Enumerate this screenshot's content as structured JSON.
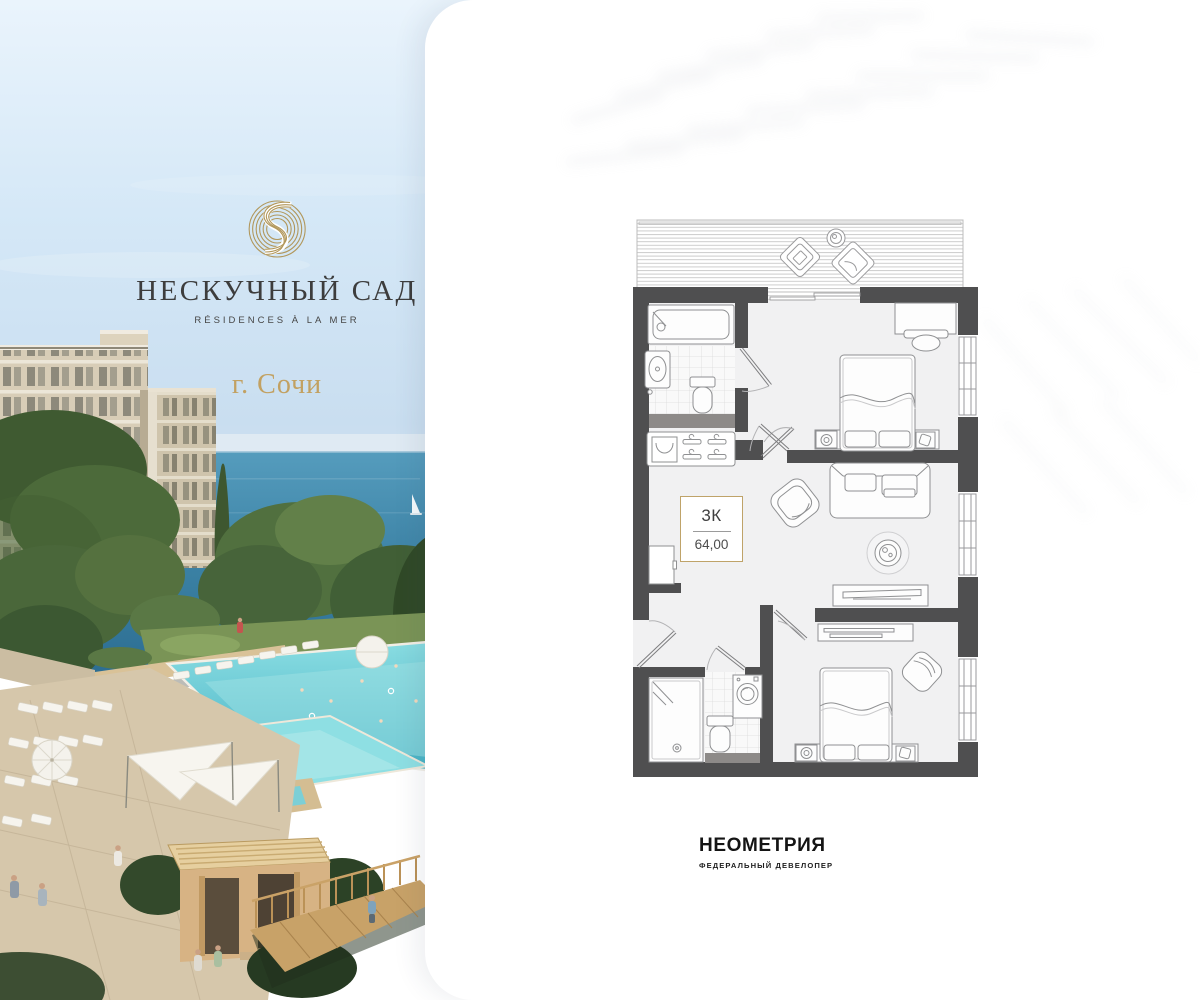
{
  "brand": {
    "name": "НЕСКУЧНЫЙ САД",
    "tagline": "RÉSIDENCES À LA MER",
    "city": "г. Сочи",
    "monogram_icon": "spiral-s-monogram-icon",
    "gold": "#b1975b",
    "text_color": "#3d3d3d"
  },
  "plan": {
    "rooms_label": "3К",
    "area": "64,00",
    "label_border_color": "#bfa369",
    "wall_color": "#4f4f50",
    "floor_color": "#f1f1f2"
  },
  "developer": {
    "name": "НЕОМЕТРИЯ",
    "subtitle": "ФЕДЕРАЛЬНЫЙ ДЕВЕЛОПЕР"
  },
  "colors": {
    "sky": "#d7e9f7",
    "sea": "#3f86a8",
    "pool": "#62c9d4",
    "card": "#ffffff"
  }
}
